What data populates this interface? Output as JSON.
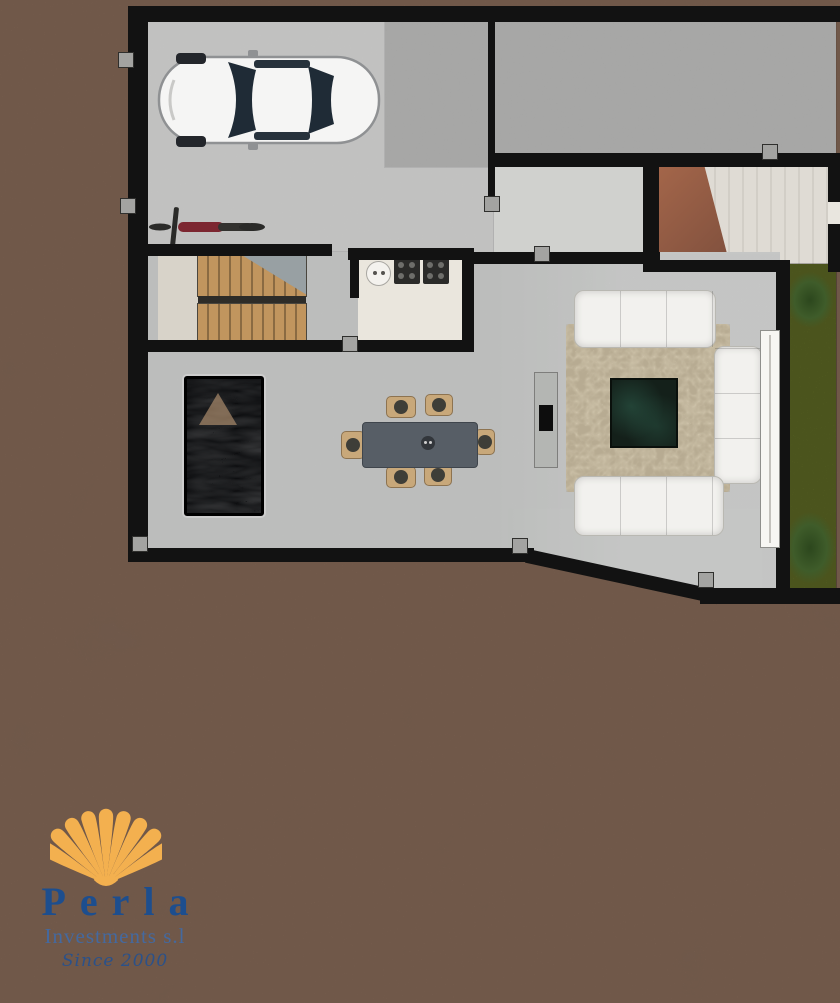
{
  "logo": {
    "brand": "Perla",
    "subtitle": "Investments s.l",
    "tagline": "Since 2000",
    "shell_icon": "scallop-shell",
    "shell_color": "#f3b04f",
    "brand_color": "#1d4e8e"
  },
  "palette": {
    "terrain_brown": "#8c6f5f",
    "wall_black": "#121212",
    "driveway_concrete": "#c7c8c6",
    "gravel_gray": "#aeafab",
    "hall_gray": "#d0d1ce",
    "plaster_cream": "#d8d3ca",
    "ramp_wood": "#a4664a",
    "stair_wood": "#c1955e",
    "garden_green": "#75832e",
    "hedge_green": "#3f5c2a",
    "rug_beige": "#cdc2a9",
    "sofa_white": "#f2f1ee",
    "dining_table_gray": "#575e66",
    "chair_tan": "#c8a87a",
    "water_feature_dark": "#0d0e10",
    "coffee_table_green": "#14201a",
    "tv_black": "#0d0d0d",
    "car_white": "#f5f5f4",
    "motorcycle_maroon": "#7c2630"
  },
  "features": [
    "white-car-top-view",
    "motorcycle",
    "wood-staircase",
    "kitchen-counter",
    "round-sink",
    "two-cooktops",
    "dining-table-with-six-chairs",
    "tv-console",
    "dark-water-feature",
    "textured-area-rug",
    "square-coffee-table",
    "three-white-sofas",
    "lawn-strip-with-hedges",
    "sliding-glass-door",
    "gravel-pad",
    "concrete-driveway",
    "earth-terrain"
  ]
}
